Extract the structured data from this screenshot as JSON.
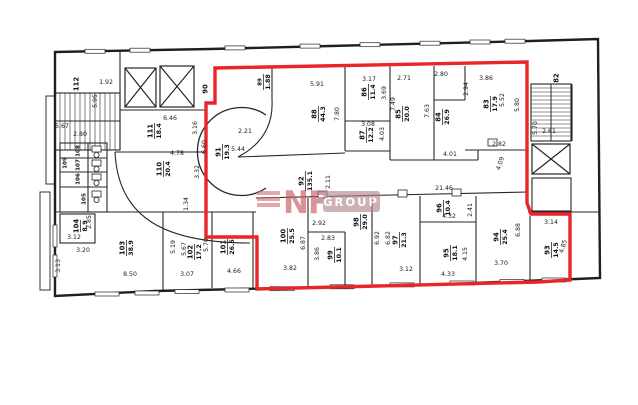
{
  "watermark": {
    "brand": "NF",
    "group": "GROUP"
  },
  "colors": {
    "highlight": "#e8252a",
    "wall": "#1f1f1f",
    "watermark_red": "#c2565c",
    "watermark_box": "#b5898d"
  },
  "plan": {
    "rooms": [
      {
        "n": "112",
        "a": "",
        "x": 76,
        "y": 84,
        "small": false
      },
      {
        "n": "111",
        "a": "18.4",
        "x": 154,
        "y": 131,
        "small": false
      },
      {
        "n": "110",
        "a": "20.4",
        "x": 163,
        "y": 169,
        "small": false
      },
      {
        "n": "109",
        "a": "",
        "x": 64,
        "y": 163,
        "small": true
      },
      {
        "n": "108",
        "a": "",
        "x": 77,
        "y": 151,
        "small": true
      },
      {
        "n": "107",
        "a": "",
        "x": 77,
        "y": 165,
        "small": true
      },
      {
        "n": "106",
        "a": "",
        "x": 77,
        "y": 179,
        "small": true
      },
      {
        "n": "105",
        "a": "",
        "x": 83,
        "y": 199,
        "small": true
      },
      {
        "n": "104",
        "a": "8.9",
        "x": 80,
        "y": 226,
        "small": false
      },
      {
        "n": "103",
        "a": "38.9",
        "x": 126,
        "y": 248,
        "small": false
      },
      {
        "n": "102",
        "a": "17.2",
        "x": 194,
        "y": 252,
        "small": false
      },
      {
        "n": "101",
        "a": "26.5",
        "x": 227,
        "y": 247,
        "small": false
      },
      {
        "n": "100",
        "a": "25.5",
        "x": 287,
        "y": 236,
        "small": false
      },
      {
        "n": "99",
        "a": "10.1",
        "x": 334,
        "y": 255,
        "small": false
      },
      {
        "n": "98",
        "a": "29.0",
        "x": 360,
        "y": 222,
        "small": false
      },
      {
        "n": "97",
        "a": "21.3",
        "x": 399,
        "y": 240,
        "small": false
      },
      {
        "n": "96",
        "a": "10.4",
        "x": 443,
        "y": 208,
        "small": false
      },
      {
        "n": "95",
        "a": "18.1",
        "x": 450,
        "y": 253,
        "small": false
      },
      {
        "n": "94",
        "a": "25.4",
        "x": 500,
        "y": 237,
        "small": false
      },
      {
        "n": "93",
        "a": "14.5",
        "x": 551,
        "y": 250,
        "small": false
      },
      {
        "n": "92",
        "a": "135.1",
        "x": 305,
        "y": 181,
        "small": false
      },
      {
        "n": "91",
        "a": "19.3",
        "x": 222,
        "y": 152,
        "small": false
      },
      {
        "n": "90",
        "a": "",
        "x": 205,
        "y": 89,
        "small": false
      },
      {
        "n": "89",
        "a": "1.88",
        "x": 263,
        "y": 82,
        "small": true
      },
      {
        "n": "88",
        "a": "44.3",
        "x": 318,
        "y": 114,
        "small": false
      },
      {
        "n": "87",
        "a": "12.2",
        "x": 366,
        "y": 135,
        "small": false
      },
      {
        "n": "86",
        "a": "11.4",
        "x": 368,
        "y": 92,
        "small": false
      },
      {
        "n": "85",
        "a": "20.0",
        "x": 402,
        "y": 114,
        "small": false
      },
      {
        "n": "84",
        "a": "26.9",
        "x": 442,
        "y": 117,
        "small": false
      },
      {
        "n": "83",
        "a": "17.9",
        "x": 490,
        "y": 104,
        "small": false
      },
      {
        "n": "82",
        "a": "",
        "x": 556,
        "y": 78,
        "small": false
      }
    ],
    "dimensions": [
      {
        "t": "1.92",
        "x": 106,
        "y": 84,
        "r": 0
      },
      {
        "t": "5.95",
        "x": 97,
        "y": 101,
        "r": -90
      },
      {
        "t": "6.46",
        "x": 170,
        "y": 120,
        "r": 0
      },
      {
        "t": "5.67",
        "x": 62,
        "y": 128,
        "r": 0
      },
      {
        "t": "2.80",
        "x": 80,
        "y": 136,
        "r": 0
      },
      {
        "t": "4.78",
        "x": 177,
        "y": 155,
        "r": 0
      },
      {
        "t": "3.16",
        "x": 197,
        "y": 128,
        "r": -90
      },
      {
        "t": "6.60",
        "x": 206,
        "y": 147,
        "r": -90
      },
      {
        "t": "3.32",
        "x": 199,
        "y": 172,
        "r": -90
      },
      {
        "t": "1.34",
        "x": 188,
        "y": 204,
        "r": -90
      },
      {
        "t": "2.21",
        "x": 245,
        "y": 133,
        "r": 0
      },
      {
        "t": "5.44",
        "x": 238,
        "y": 151,
        "r": 0
      },
      {
        "t": "5.91",
        "x": 317,
        "y": 86,
        "r": 0
      },
      {
        "t": "7.80",
        "x": 339,
        "y": 114,
        "r": -90
      },
      {
        "t": "3.17",
        "x": 369,
        "y": 81,
        "r": 0
      },
      {
        "t": "3.69",
        "x": 386,
        "y": 93,
        "r": -90
      },
      {
        "t": "2.71",
        "x": 404,
        "y": 80,
        "r": 0
      },
      {
        "t": "7.49",
        "x": 395,
        "y": 104,
        "r": -90
      },
      {
        "t": "3.08",
        "x": 368,
        "y": 126,
        "r": 0
      },
      {
        "t": "4.03",
        "x": 384,
        "y": 134,
        "r": -90
      },
      {
        "t": "2.80",
        "x": 441,
        "y": 76,
        "r": 0
      },
      {
        "t": "7.63",
        "x": 429,
        "y": 111,
        "r": -90
      },
      {
        "t": "2.94",
        "x": 468,
        "y": 89,
        "r": -90
      },
      {
        "t": "3.86",
        "x": 486,
        "y": 80,
        "r": 0
      },
      {
        "t": "5.52",
        "x": 504,
        "y": 100,
        "r": -90
      },
      {
        "t": "5.80",
        "x": 519,
        "y": 105,
        "r": -90
      },
      {
        "t": "2.82",
        "x": 499,
        "y": 146,
        "r": 0
      },
      {
        "t": "4.09",
        "x": 502,
        "y": 164,
        "r": -72
      },
      {
        "t": "4.01",
        "x": 450,
        "y": 156,
        "r": 0
      },
      {
        "t": "2.11",
        "x": 330,
        "y": 182,
        "r": -90
      },
      {
        "t": "21.46",
        "x": 444,
        "y": 190,
        "r": 0
      },
      {
        "t": "5.70",
        "x": 537,
        "y": 128,
        "r": -90
      },
      {
        "t": "2.61",
        "x": 549,
        "y": 133,
        "r": 0
      },
      {
        "t": "2.92",
        "x": 319,
        "y": 225,
        "r": 0
      },
      {
        "t": "2.83",
        "x": 328,
        "y": 240,
        "r": 0
      },
      {
        "t": "6.87",
        "x": 305,
        "y": 243,
        "r": -90
      },
      {
        "t": "3.86",
        "x": 319,
        "y": 254,
        "r": -90
      },
      {
        "t": "3.82",
        "x": 290,
        "y": 270,
        "r": 0
      },
      {
        "t": "4.32",
        "x": 449,
        "y": 218,
        "r": 0
      },
      {
        "t": "2.41",
        "x": 472,
        "y": 210,
        "r": -90
      },
      {
        "t": "3.12",
        "x": 406,
        "y": 271,
        "r": 0
      },
      {
        "t": "4.33",
        "x": 448,
        "y": 276,
        "r": 0
      },
      {
        "t": "6.92",
        "x": 379,
        "y": 238,
        "r": -90
      },
      {
        "t": "6.82",
        "x": 390,
        "y": 238,
        "r": -90
      },
      {
        "t": "4.15",
        "x": 467,
        "y": 254,
        "r": -90
      },
      {
        "t": "3.70",
        "x": 501,
        "y": 265,
        "r": 0
      },
      {
        "t": "6.88",
        "x": 520,
        "y": 230,
        "r": -90
      },
      {
        "t": "3.14",
        "x": 551,
        "y": 224,
        "r": 0
      },
      {
        "t": "4.85",
        "x": 565,
        "y": 247,
        "r": -72
      },
      {
        "t": "2.85",
        "x": 91,
        "y": 222,
        "r": -90
      },
      {
        "t": "3.12",
        "x": 74,
        "y": 239,
        "r": 0
      },
      {
        "t": "3.20",
        "x": 83,
        "y": 252,
        "r": 0
      },
      {
        "t": "3.13",
        "x": 60,
        "y": 266,
        "r": -90
      },
      {
        "t": "8.50",
        "x": 130,
        "y": 276,
        "r": 0
      },
      {
        "t": "5.19",
        "x": 175,
        "y": 247,
        "r": -90
      },
      {
        "t": "5.67",
        "x": 186,
        "y": 249,
        "r": -90
      },
      {
        "t": "3.07",
        "x": 187,
        "y": 276,
        "r": 0
      },
      {
        "t": "5.70",
        "x": 208,
        "y": 245,
        "r": -90
      },
      {
        "t": "4.66",
        "x": 234,
        "y": 273,
        "r": 0
      }
    ]
  }
}
